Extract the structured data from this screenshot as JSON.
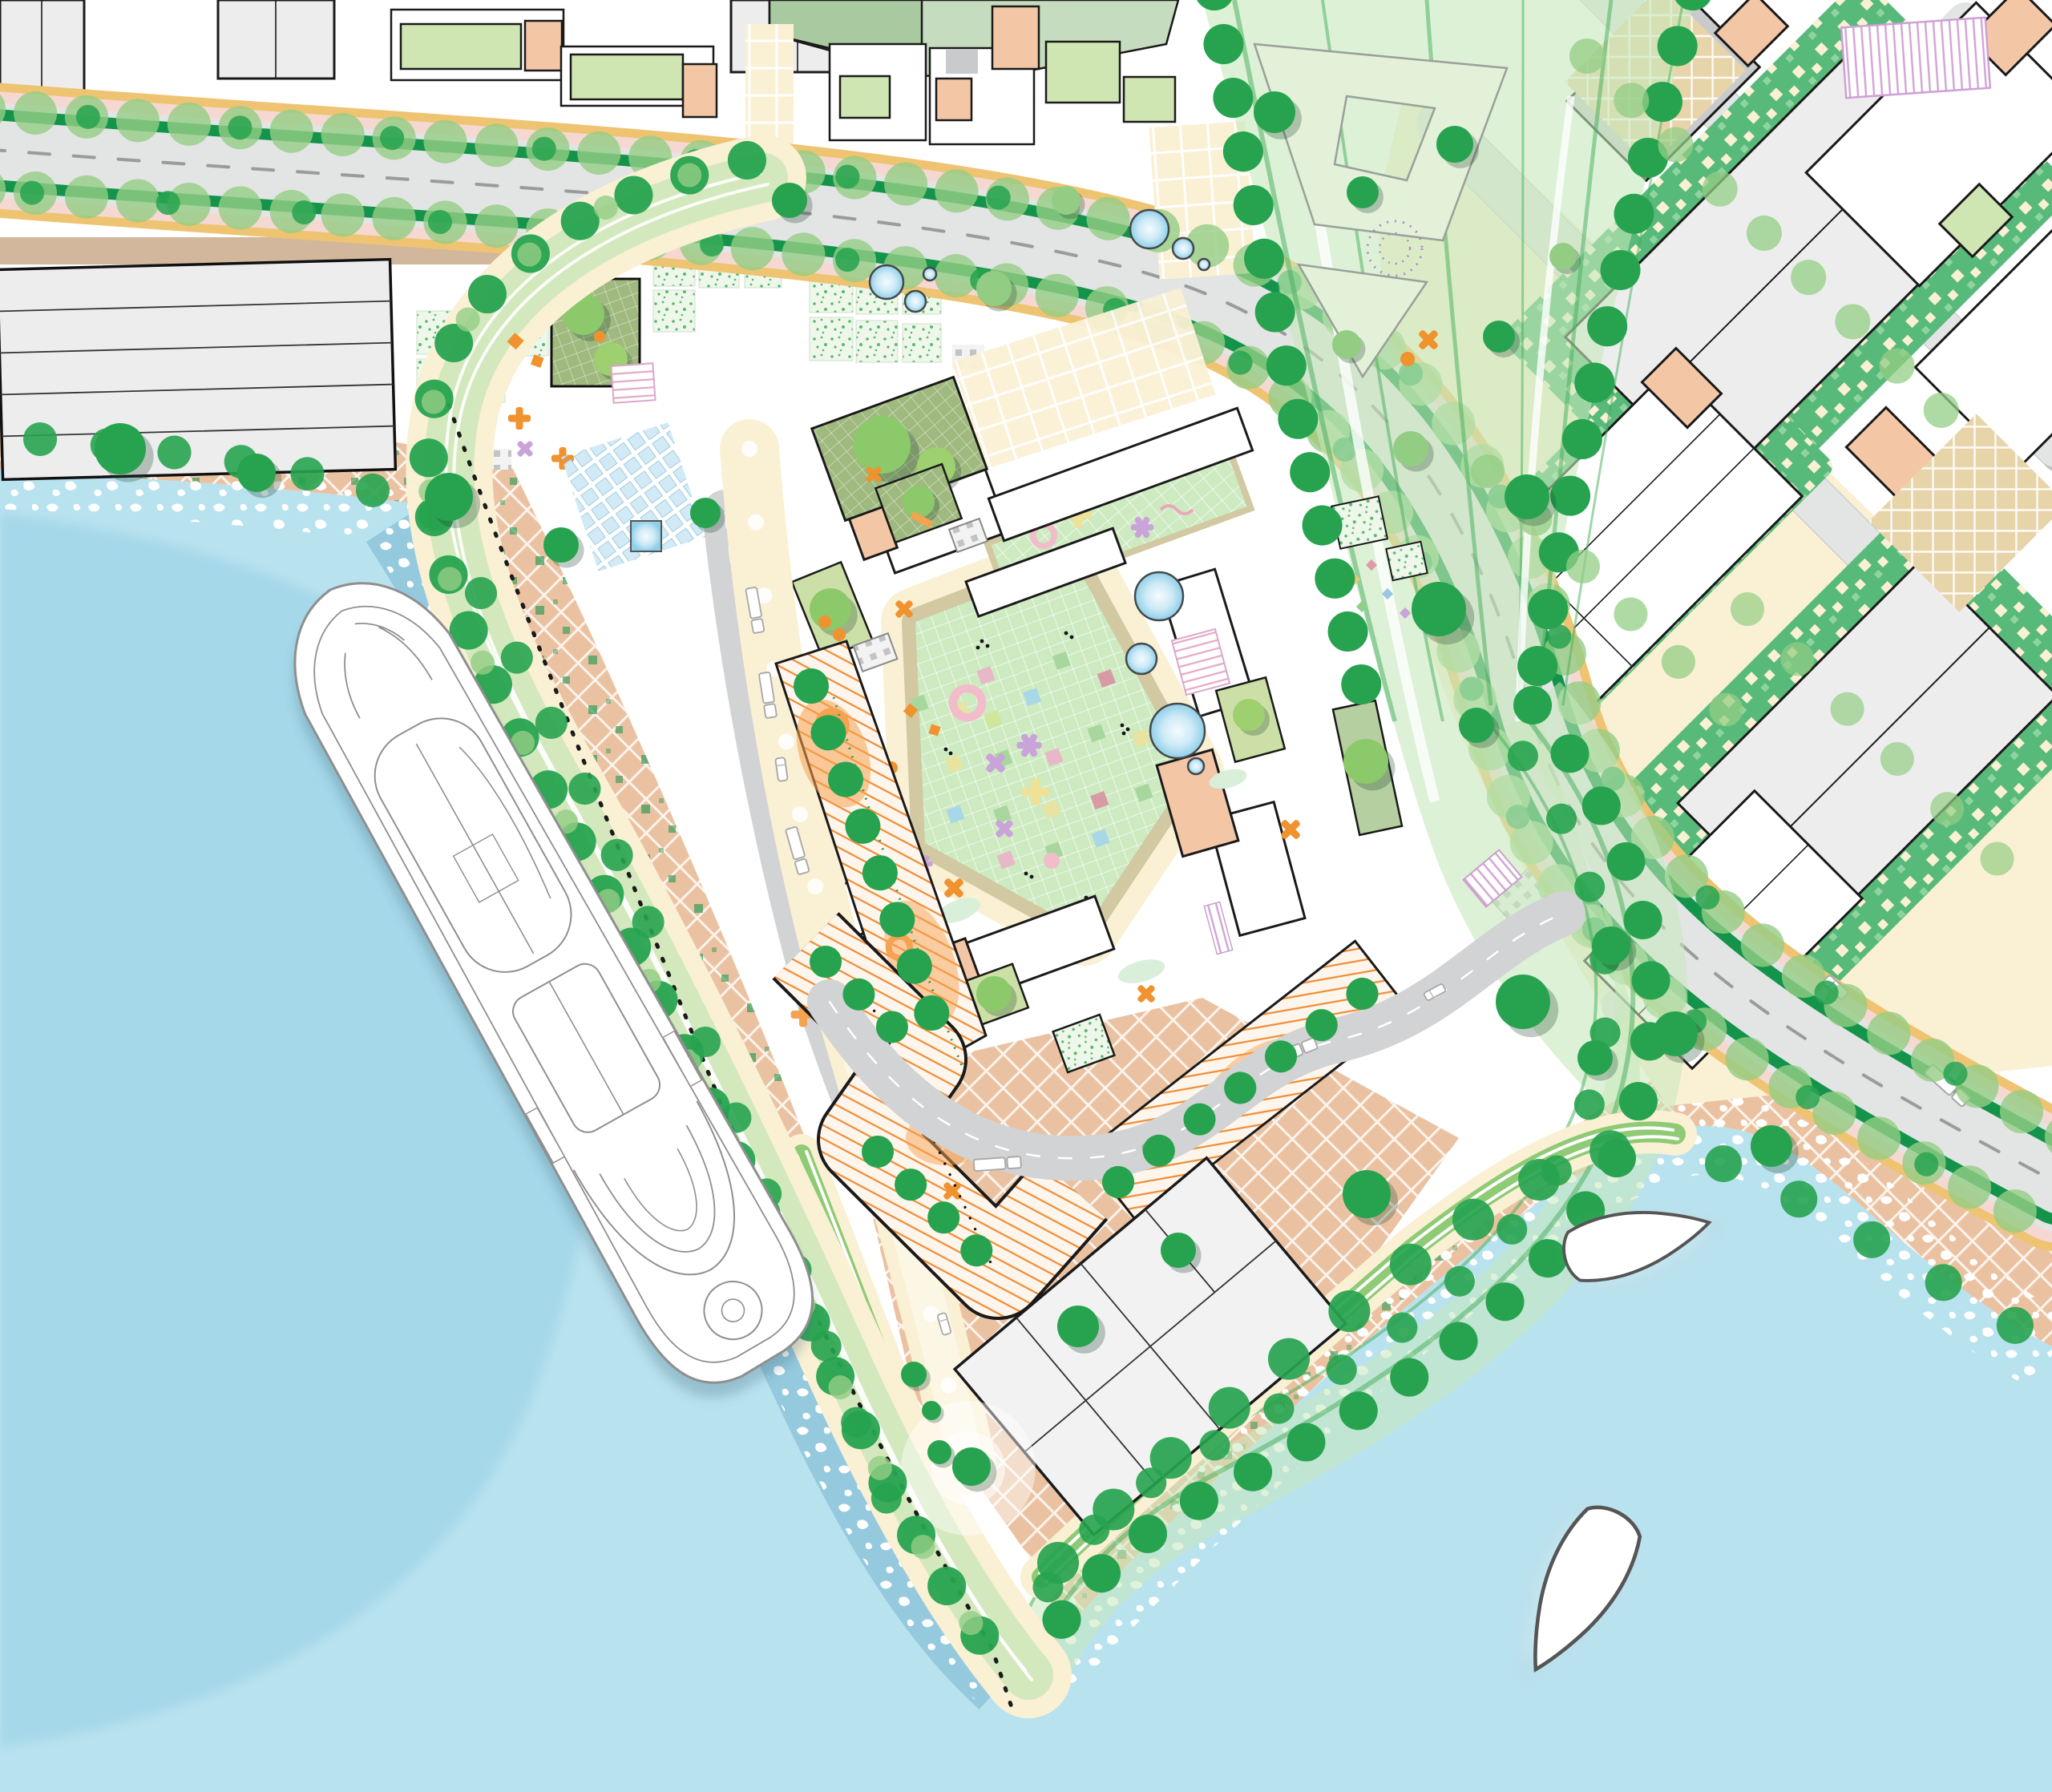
{
  "title": "Waterfront masterplan site plan",
  "description": "Illustrated urban-design masterplan: cruise-ship quay, green promenade loop, courtyard housing block with mosaic plaza, tree-lined boulevards, industrial blocks and harbour water with boats.",
  "map": {
    "kind": "architectural-site-plan",
    "orientation": "plan-view",
    "water_bodies": 2,
    "cruise_ships": 1,
    "small_boats": 2,
    "ponds": 10,
    "boulevards": 2,
    "legend": [
      {
        "name": "harbor-water",
        "color_key": "water"
      },
      {
        "name": "shore-foam",
        "color_key": "foam"
      },
      {
        "name": "quay-paving",
        "color_key": "quay"
      },
      {
        "name": "cream-promenade",
        "color_key": "cream"
      },
      {
        "name": "linear-green-band",
        "color_key": "band"
      },
      {
        "name": "street-trees",
        "color_key": "tree"
      },
      {
        "name": "boulevard-verge",
        "color_key": "verge"
      },
      {
        "name": "cycle-lane",
        "color_key": "amber"
      },
      {
        "name": "sidewalk",
        "color_key": "pink_walk"
      },
      {
        "name": "mosaic-courtyard-plaza",
        "color_key": "mosaic"
      },
      {
        "name": "orange-play-strip",
        "color_key": "orange"
      },
      {
        "name": "pixel-hedge-garden",
        "color_key": "pixel"
      },
      {
        "name": "building-roof",
        "color_key": "bldg"
      },
      {
        "name": "accent-building",
        "color_key": "peach"
      },
      {
        "name": "industrial-shed",
        "color_key": "bldg_gray"
      }
    ]
  },
  "colors": {
    "water": "#b9e2ef",
    "water_deep": "#a5d8e9",
    "water_shadow": "#8cc3da",
    "foam": "#ffffff",
    "land": "#ffffff",
    "quay": "#eac2a1",
    "quay_light": "#f3d8c6",
    "cream": "#faf0d4",
    "cream_edge": "#e8d7a9",
    "tan_plaza": "#e8d4a9",
    "road": "#e3e4e4",
    "road_mid": "#d2d3d4",
    "road_shadow": "#c2c4c5",
    "dash": "#9b9b9b",
    "verge": "#14944a",
    "amber": "#eec472",
    "pink_walk": "#f6d8d2",
    "tan_walk": "#d2b79c",
    "walk_olive": "#d2c8a2",
    "tree": "#27a34f",
    "tree_dark": "#12813f",
    "tree_light": "#93cd84",
    "band": "#b9e3ae",
    "band_line": "#46ae5b",
    "pale_plaza": "#e2f1d8",
    "pixel": "#57b97a",
    "mosaic": "#cdeac1",
    "speckle": "#57b96e",
    "olive_garden": "#ccdfa6",
    "roof_grid": "#9fb97e",
    "sage": "#a9c9a1",
    "sage_light": "#c6dcbf",
    "roof_green": "#cfe5b2",
    "bldg": "#ffffff",
    "bldg_gray": "#ededee",
    "bldg_gray2": "#c9cacc",
    "outline": "#1a1a1a",
    "peach": "#f3c7a6",
    "orange": "#f0922e",
    "orange_soft": "#f5a251",
    "pond_edge": "#44474a",
    "glyph_lavender": "#c9a3d9",
    "glyph_pink": "#f3bcca",
    "glyph_yellow": "#efe195",
    "stripe_lav": "#d0a4d4",
    "ship_line": "#8f8f8f",
    "boat_line": "#555555"
  }
}
